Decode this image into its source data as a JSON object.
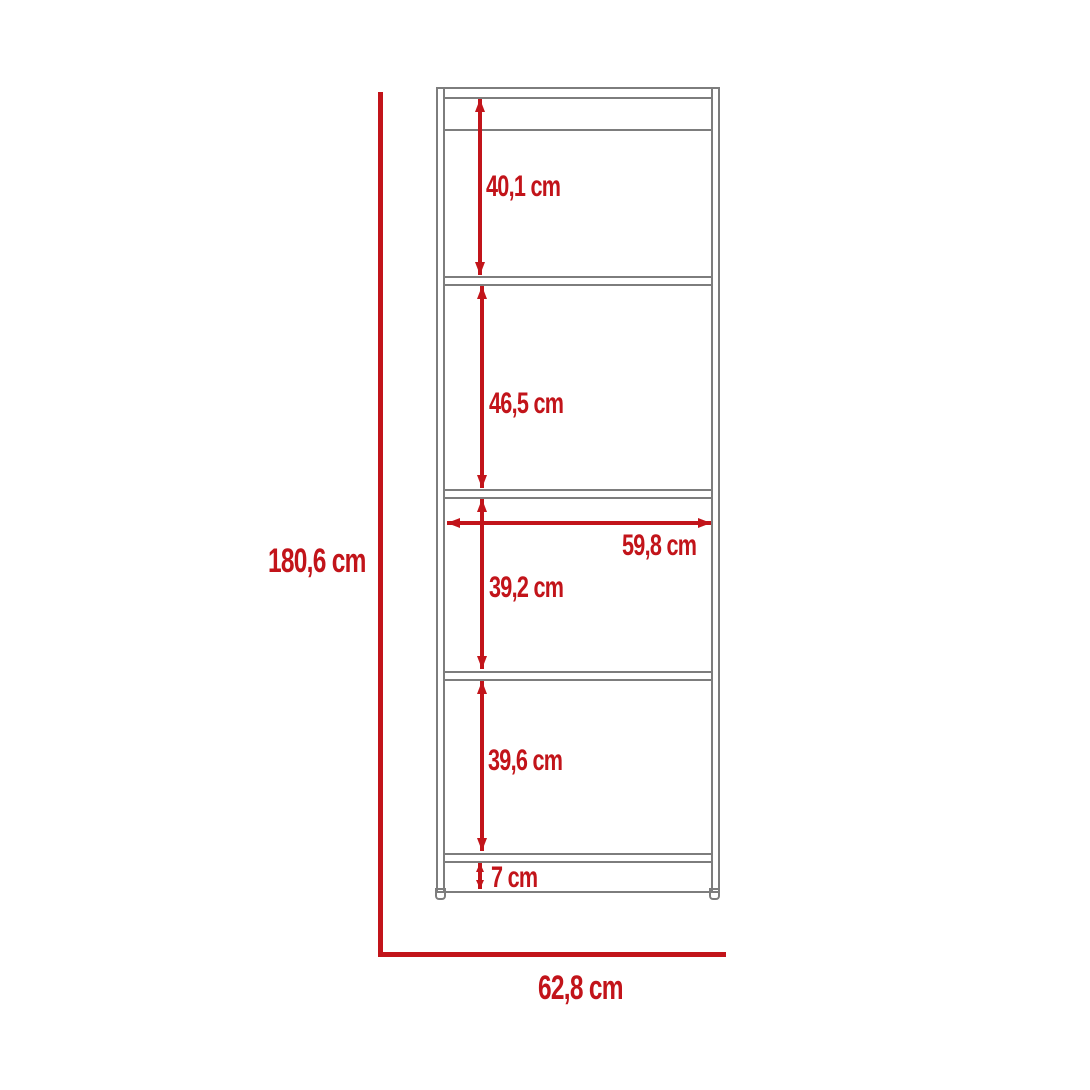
{
  "figure": {
    "type": "furniture-dimension-diagram",
    "subject": "tall bookcase with four open shelves and base",
    "unit": "cm"
  },
  "colors": {
    "accent_red": "#c2141a",
    "line_gray": "#7d7d7d",
    "background": "#ffffff"
  },
  "dimensions": {
    "total_height": {
      "label": "180,6 cm",
      "value": 180.6
    },
    "total_width": {
      "label": "62,8 cm",
      "value": 62.8
    },
    "inner_width": {
      "label": "59,8 cm",
      "value": 59.8
    },
    "sections": [
      {
        "name": "top opening",
        "label": "40,1 cm",
        "value": 40.1
      },
      {
        "name": "second opening",
        "label": "46,5 cm",
        "value": 46.5
      },
      {
        "name": "third opening",
        "label": "39,2 cm",
        "value": 39.2
      },
      {
        "name": "fourth opening",
        "label": "39,6 cm",
        "value": 39.6
      },
      {
        "name": "base height",
        "label": "7 cm",
        "value": 7
      }
    ]
  }
}
